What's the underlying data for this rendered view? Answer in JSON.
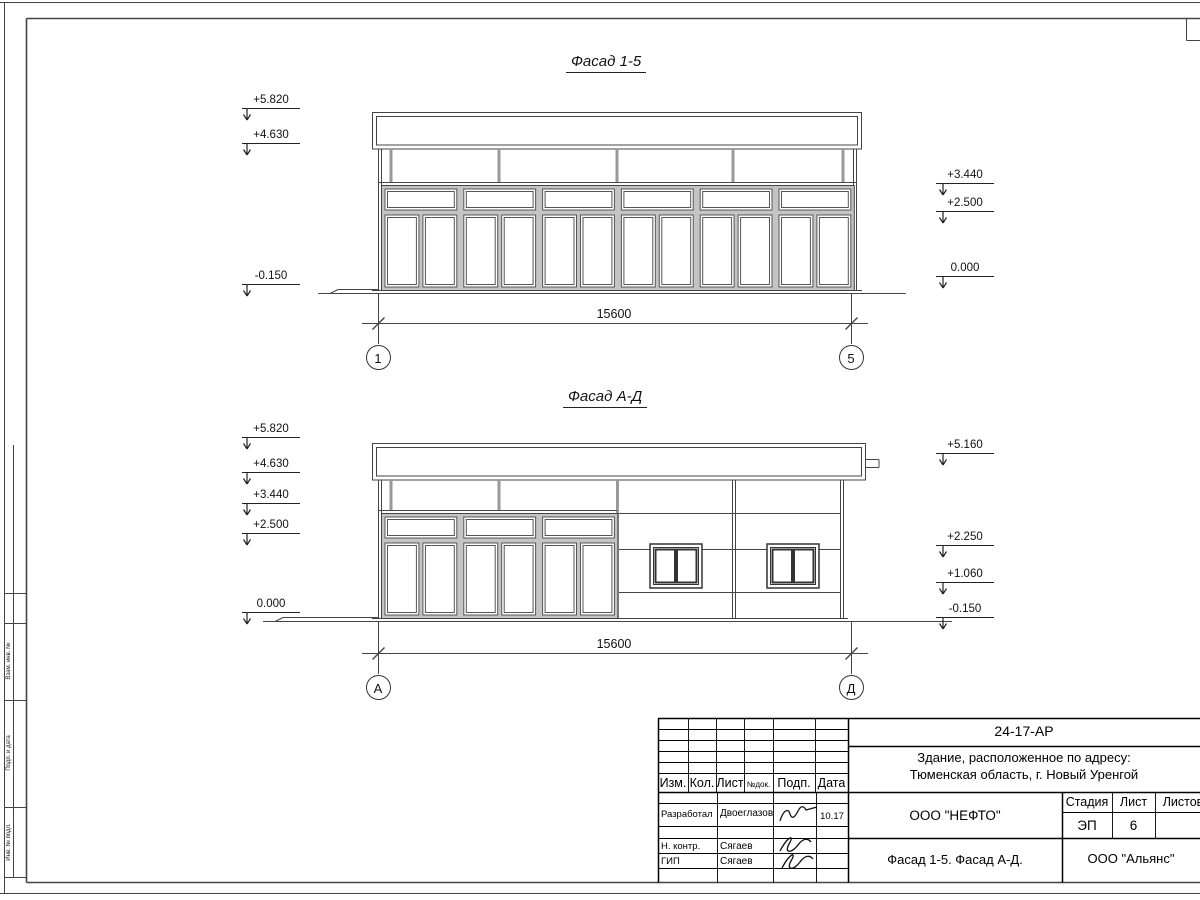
{
  "facade_1_5": {
    "title": "Фасад 1-5",
    "marks_left": [
      "+5.820",
      "+4.630",
      "-0.150"
    ],
    "marks_right": [
      "+3.440",
      "+2.500",
      "0.000"
    ],
    "dimension": "15600",
    "axis_start": "1",
    "axis_end": "5"
  },
  "facade_a_d": {
    "title": "Фасад А-Д",
    "marks_left": [
      "+5.820",
      "+4.630",
      "+3.440",
      "+2.500",
      "0.000"
    ],
    "marks_right": [
      "+5.160",
      "+2.250",
      "+1.060",
      "-0.150"
    ],
    "dimension": "15600",
    "axis_start": "А",
    "axis_end": "Д"
  },
  "title_block": {
    "doc_number": "24-17-АР",
    "object_line1": "Здание, расположенное по адресу:",
    "object_line2": "Тюменская область, г. Новый Уренгой",
    "col_izm": "Изм.",
    "col_kol": "Кол.",
    "col_list": "Лист",
    "col_ndok": "№док.",
    "col_podp": "Подп.",
    "col_data": "Дата",
    "row1_role": "Разработал",
    "row1_name": "Двоеглазов",
    "row1_date": "10.17",
    "row2_role": "Н. контр.",
    "row2_name": "Сягаев",
    "row3_role": "ГИП",
    "row3_name": "Сягаев",
    "client": "ООО \"НЕФТО\"",
    "stage_label": "Стадия",
    "sheet_label": "Лист",
    "sheets_label": "Листов",
    "stage": "ЭП",
    "sheet_no": "6",
    "sheet_title": "Фасад 1-5. Фасад А-Д.",
    "company": "ООО \"Альянс\""
  },
  "frame": {
    "side_label_1": "Взам. инв. №",
    "side_label_2": "Подп. и дата",
    "side_label_3": "Инв. № подл."
  }
}
